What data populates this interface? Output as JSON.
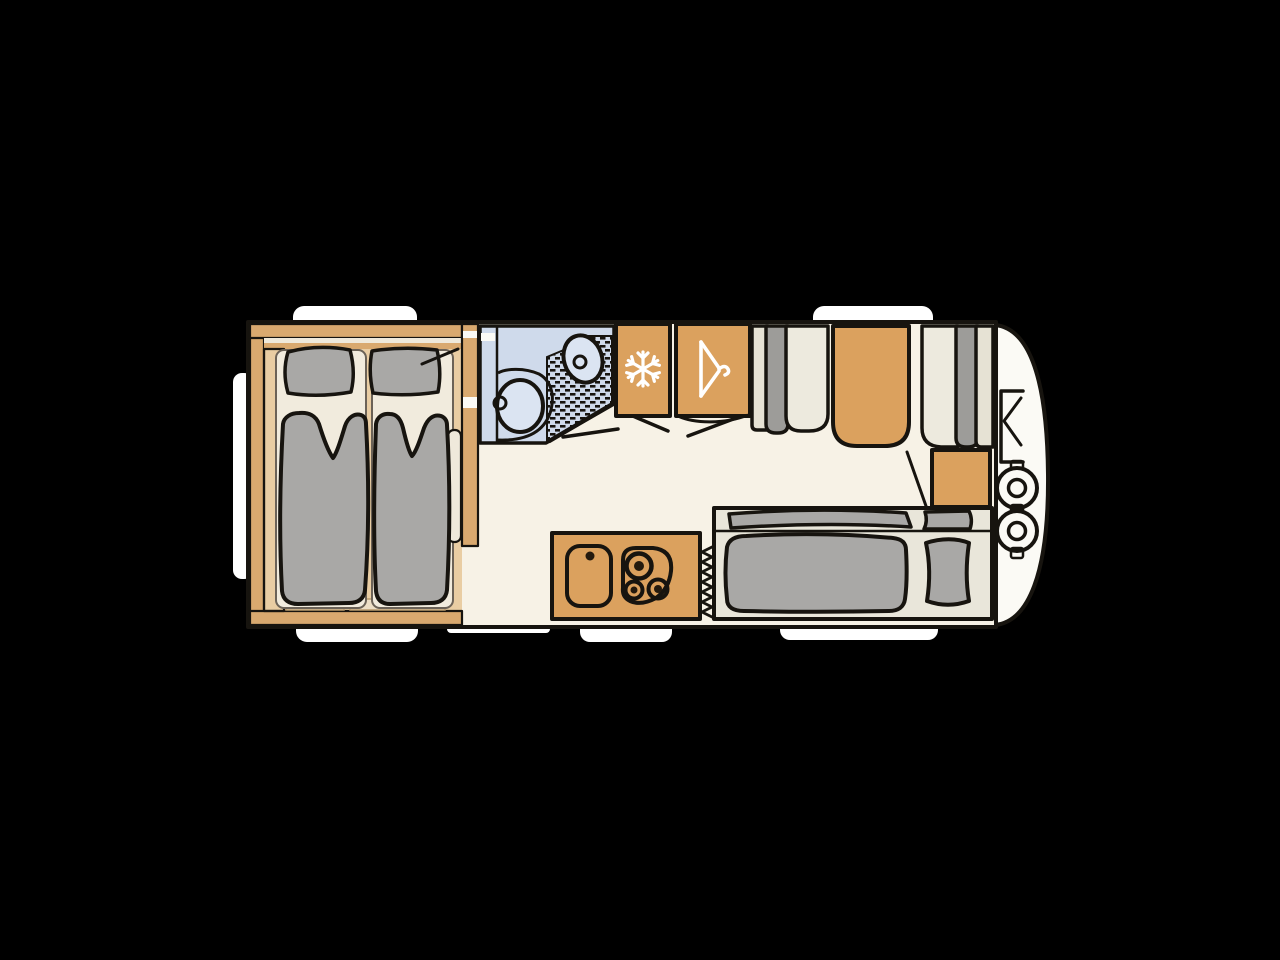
{
  "meta": {
    "title": "Caravan floor plan, top view",
    "style": "hand-drawn illustration"
  },
  "colors": {
    "background": "#000000",
    "body": "#fbfaf5",
    "floor": "#f7f2e6",
    "bedroom_floor": "#e9cda3",
    "wall_wood": "#d9a96f",
    "wood": "#dba15e",
    "mattress": "#f1ebdd",
    "panel": "#efe9db",
    "board": "#eddfc6",
    "cushion": "#a9a8a6",
    "cushion_dark": "#9d9c99",
    "seat": "#e9e6da",
    "seat_back": "#e6e2d4",
    "seat_light": "#edeade",
    "bath": "#cfdaeb",
    "bath_light": "#dbe4f2",
    "outline": "#17140f",
    "white": "#ffffff"
  },
  "rooms": {
    "bedroom": {
      "label": "rear bedroom with twin beds",
      "beds": 2,
      "pillows": 2
    },
    "bathroom": {
      "label": "washroom",
      "fixtures": [
        "toilet",
        "washbasin",
        "shower"
      ]
    },
    "fridge": {
      "label": "refrigerator",
      "icon": "snowflake-icon"
    },
    "wardrobe": {
      "label": "wardrobe",
      "icon": "hanger-icon"
    },
    "dinette": {
      "label": "dinette with table",
      "seats": 2
    },
    "kitchen": {
      "label": "kitchen block",
      "fixtures": [
        "sink",
        "hob"
      ],
      "burners": 3
    },
    "lounge": {
      "label": "side bench",
      "cushions": 2
    },
    "gas_locker": {
      "label": "front locker",
      "gas_bottles": 2
    }
  },
  "openings": {
    "windows_top": 2,
    "windows_bottom": 3,
    "window_rear": 1,
    "entry_door": 1
  }
}
